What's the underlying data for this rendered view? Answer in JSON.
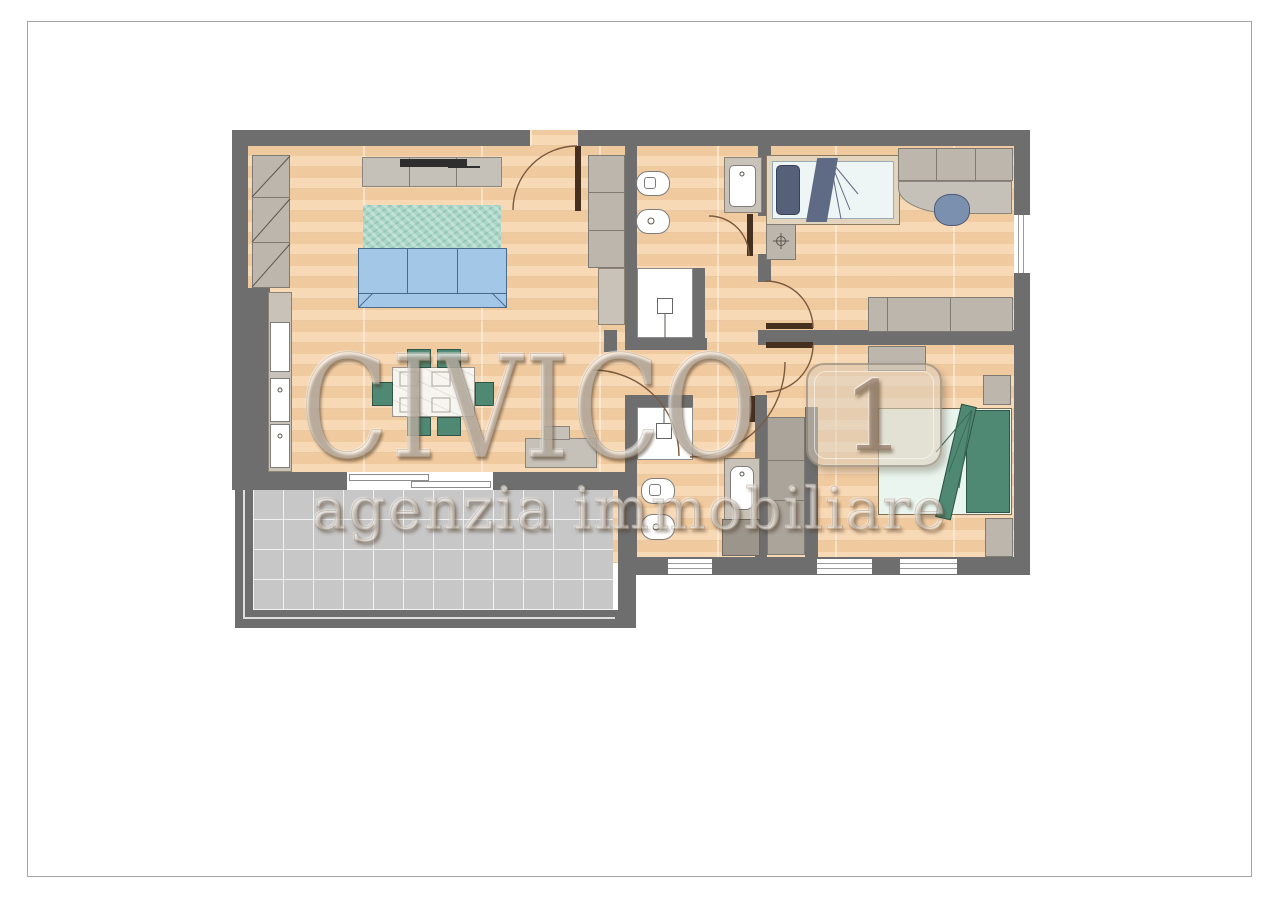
{
  "watermark": {
    "brand": "CIVICO",
    "number": "1",
    "tagline": "agenzia immobiliare"
  },
  "palette": {
    "wall": "#6e6e6e",
    "wood_floor": "#f3d0a8",
    "terrace_tile": "#c7c7c7",
    "furniture_grey": "#bcb6ad",
    "sofa_blue": "#a3c7e7",
    "rug_teal": "#a9d6c6",
    "chair_green": "#4f8974",
    "bed1_textile_blue": "#5f6b85",
    "bed2_textile_green": "#4f8974",
    "fixture_white": "#ffffff",
    "door_leaf_brown": "#452f1f",
    "door_arc_brown": "#7a5a40",
    "page_border_grey": "#a5a5a5"
  }
}
